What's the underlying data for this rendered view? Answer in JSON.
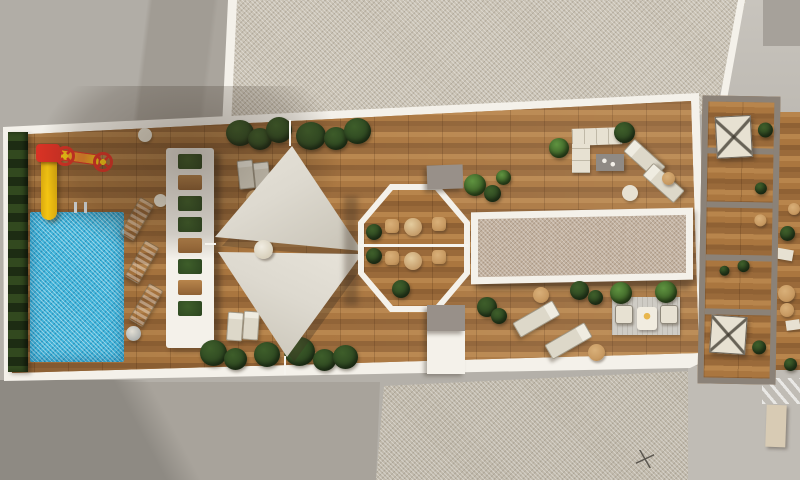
{
  "scene": {
    "type": "architectural-render",
    "view": "top-down-aerial",
    "subject": "rooftop communal terrace with pool, shade sails, gazebo and private terraces",
    "areas": [
      "pool-zone",
      "kids-slide",
      "pool-lounger-row",
      "slatted-pergola",
      "shade-sail-deck",
      "octagonal-gazebo",
      "fabric-canopy",
      "lounge-corner",
      "sunbed-corner",
      "seating-nook",
      "private-terraces",
      "neighbor-roofs",
      "streets"
    ]
  },
  "colors": {
    "base_gray": "#b4b0a9",
    "roof_smooth": "#b1ada6",
    "roof_smooth_shadow": "#8e8a83",
    "gravel": "#c9c2b4",
    "gravel_dark": "#c0b9ab",
    "street": "#c0bcb5",
    "parapet_white": "#f4f1ea",
    "wood_a": "#aa763f",
    "wood_b": "#8f6134",
    "wood_c": "#b8854c",
    "pool_blue": "#41b4da",
    "hedge_green": "#26371c",
    "plant_dark": "#2c4520",
    "plant_mid": "#3e5e2a",
    "plant_bright": "#5f9340",
    "sail": "#ddd9cf",
    "sail_dark": "#c6c1b4",
    "slide_yellow": "#f4c513",
    "slide_red": "#d93225",
    "gray_box": "#989089",
    "canopy_fabric": "#c3b2a0",
    "cream": "#e7e1d2",
    "rattan": "#c89a62",
    "table_gray": "#8f8a85",
    "divider_gray": "#8b8278",
    "rug_gray": "#cfccc5",
    "lounger_gray": "#b9bdbe",
    "shadow": "rgba(62,48,34,0.35)"
  }
}
